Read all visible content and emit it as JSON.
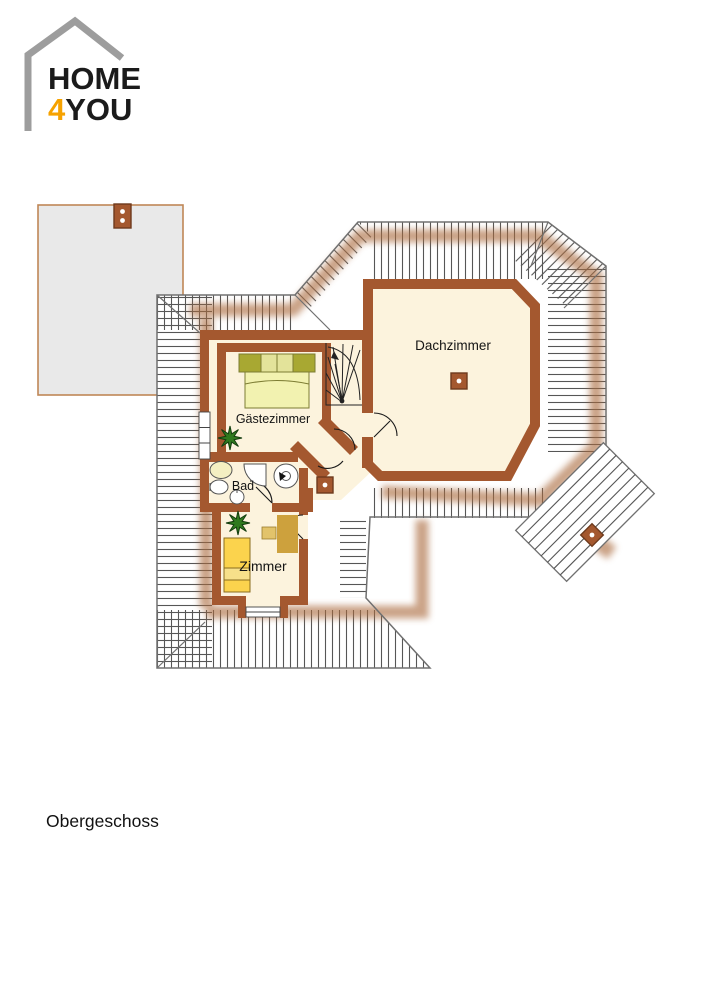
{
  "logo": {
    "line1": "HOME",
    "line2_accent": "4",
    "line2_rest": "YOU",
    "accent_color": "#F6A200",
    "house_outline_color": "#9D9D9D"
  },
  "plan": {
    "floor_label": "Obergeschoss",
    "rooms": [
      {
        "name": "Dachzimmer"
      },
      {
        "name": "Gästezimmer"
      },
      {
        "name": "Bad"
      },
      {
        "name": "Zimmer"
      }
    ],
    "colors": {
      "wall_brown": "#A4582F",
      "room_fill": "#FCF3DD",
      "roof_hatch": "#565656",
      "roof_edge": "#707070",
      "eaves_band": "#AA6A3C",
      "annex_fill": "#E9E9E9",
      "annex_border": "#BF8756",
      "bed_guest_pillow_dark": "#A8A832",
      "bed_guest_pillow_light": "#E3E39A",
      "bed_guest_body": "#F2F2B0",
      "bed_room_yellow": "#FBD34D",
      "desk_tan": "#CDA13D",
      "chair_tan": "#E2C36B",
      "plant_green": "#2F7A1E"
    }
  }
}
